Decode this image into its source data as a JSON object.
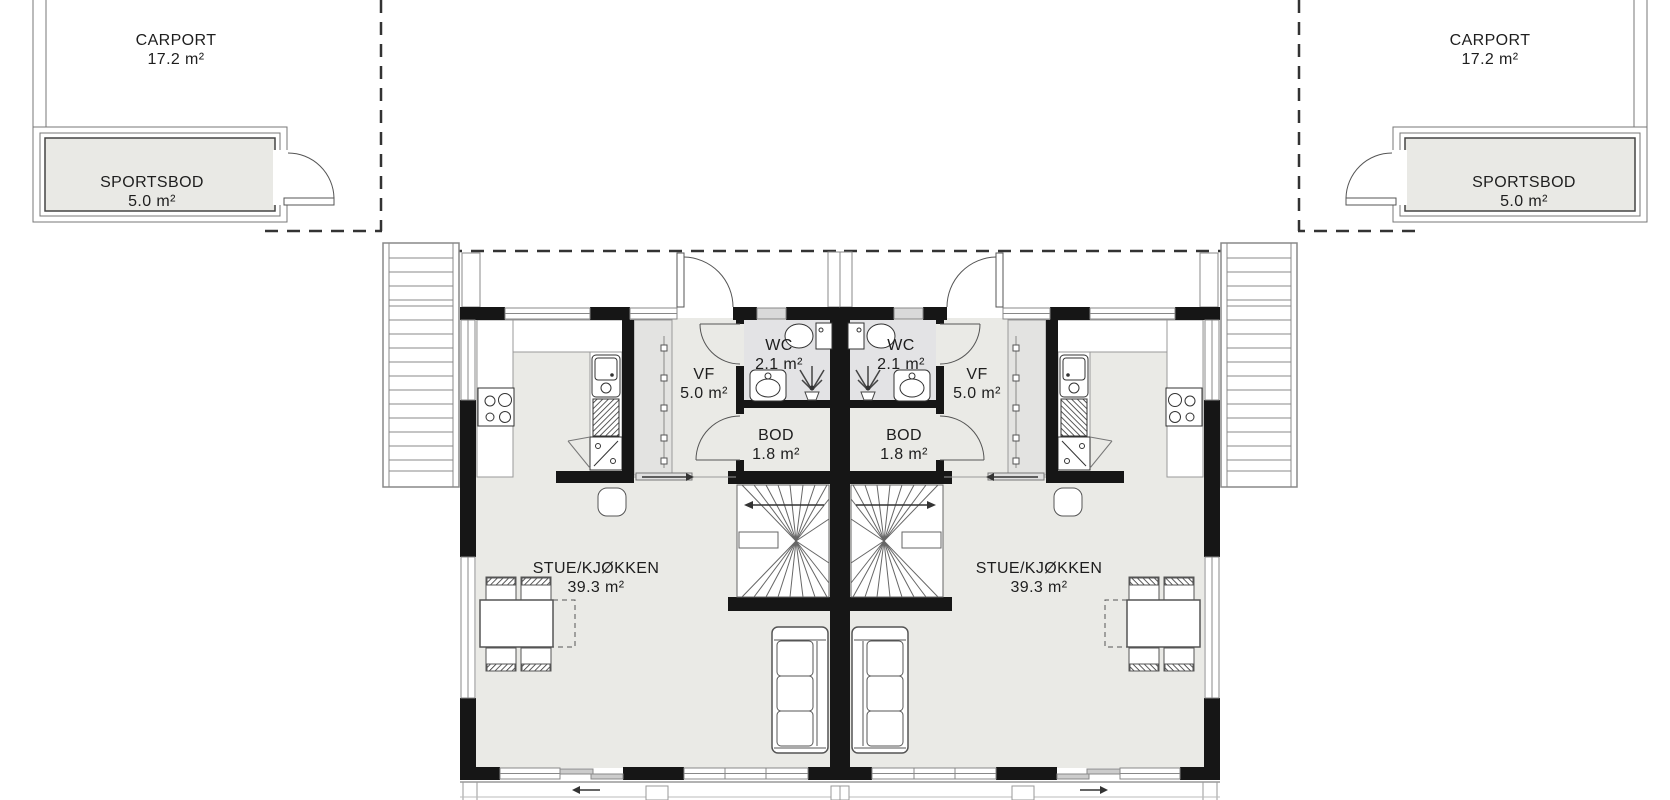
{
  "drawing": {
    "type": "floor-plan",
    "units": 2,
    "colors": {
      "wall": "#161616",
      "floor": "#eaeae6",
      "wet_room_floor": "#e3e3e5",
      "storage_floor": "#e9e9e5",
      "vent_window": "#d9d9d9",
      "line": "#777777",
      "text": "#1e1e1e"
    }
  },
  "labels": {
    "carport_left": {
      "name": "CARPORT",
      "area": "17.2 m²"
    },
    "carport_right": {
      "name": "CARPORT",
      "area": "17.2 m²"
    },
    "sportsbod_left": {
      "name": "SPORTSBOD",
      "area": "5.0 m²"
    },
    "sportsbod_right": {
      "name": "SPORTSBOD",
      "area": "5.0 m²"
    },
    "wc_left": {
      "name": "WC",
      "area": "2.1 m²"
    },
    "wc_right": {
      "name": "WC",
      "area": "2.1 m²"
    },
    "vf_left": {
      "name": "VF",
      "area": "5.0 m²"
    },
    "vf_right": {
      "name": "VF",
      "area": "5.0 m²"
    },
    "bod_left": {
      "name": "BOD",
      "area": "1.8 m²"
    },
    "bod_right": {
      "name": "BOD",
      "area": "1.8 m²"
    },
    "stue_left": {
      "name": "STUE/KJØKKEN",
      "area": "39.3 m²"
    },
    "stue_right": {
      "name": "STUE/KJØKKEN",
      "area": "39.3 m²"
    }
  }
}
